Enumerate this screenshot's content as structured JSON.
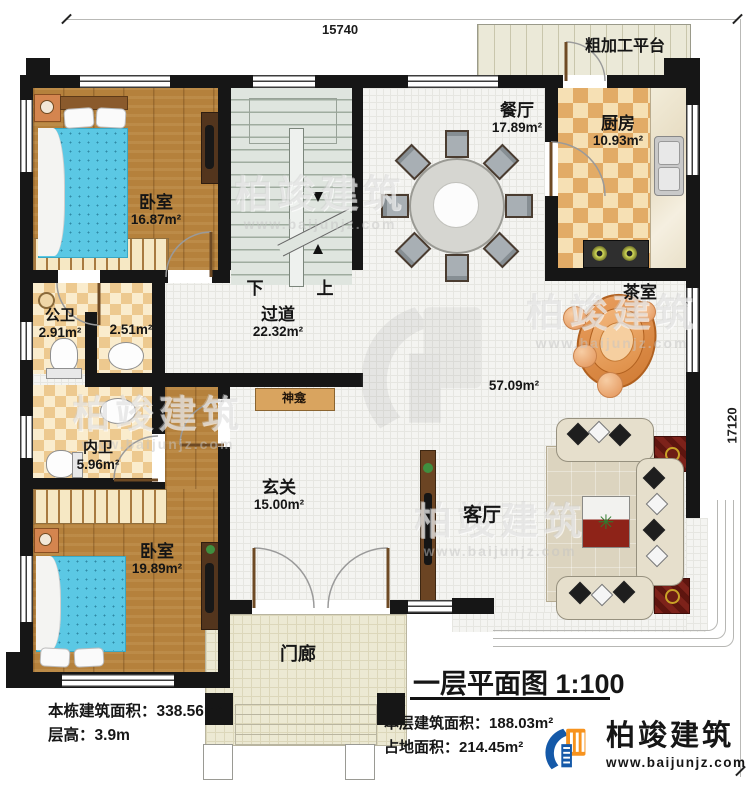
{
  "dimensions": {
    "width_top": "15740",
    "height_right": "17120"
  },
  "rooms": {
    "bedroom1": {
      "name": "卧室",
      "area": "16.87m²"
    },
    "dining": {
      "name": "餐厅",
      "area": "17.89m²"
    },
    "kitchen": {
      "name": "厨房",
      "area": "10.93m²"
    },
    "platform": {
      "name": "粗加工平台"
    },
    "hallway": {
      "name": "过道",
      "area": "22.32m²"
    },
    "public_bath": {
      "name": "公卫",
      "area": "2.91m²"
    },
    "small_bath": {
      "area": "2.51m²"
    },
    "inner_bath": {
      "name": "内卫",
      "area": "5.96m²"
    },
    "foyer": {
      "name": "玄关",
      "area": "15.00m²"
    },
    "bedroom2": {
      "name": "卧室",
      "area": "19.89m²"
    },
    "living": {
      "name": "客厅"
    },
    "tea_room": {
      "name": "茶室"
    },
    "open_area": {
      "area": "57.09m²"
    },
    "shrine": {
      "name": "神龛"
    },
    "porch": {
      "name": "门廊"
    }
  },
  "stairs": {
    "down": "下",
    "up": "上"
  },
  "footer": {
    "title": "一层平面图 1:100",
    "total_area_label": "本栋建筑面积：",
    "total_area_value": "338.56m²",
    "floor_height_label": "层高：",
    "floor_height_value": "3.9m",
    "level_area_label": "本层建筑面积：",
    "level_area_value": "188.03m²",
    "footprint_label": "占地面积：",
    "footprint_value": "214.45m²"
  },
  "brand": {
    "name": "柏竣建筑",
    "website": "www.baijunjz.com"
  },
  "watermark": {
    "name": "柏竣建筑",
    "website": "www.baijunjz.com"
  },
  "icons": {
    "plant": "✳"
  },
  "colors": {
    "wall": "#161616",
    "wood_floor": "#b5813c",
    "checker": "#e2ab66",
    "tile": "#f4f4f1",
    "stair": "#dfe5df",
    "brand_blue": "#1559a8",
    "brand_orange": "#f7931e"
  }
}
